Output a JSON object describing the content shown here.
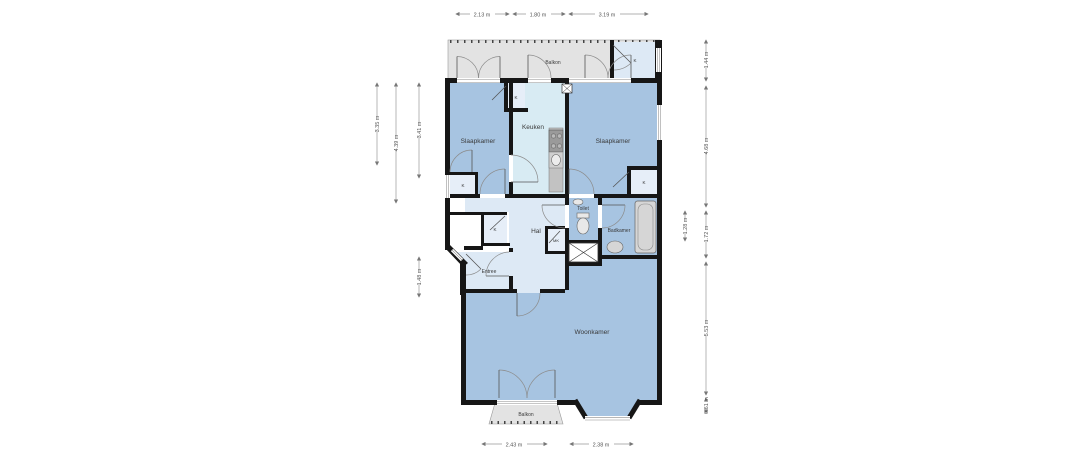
{
  "rooms": {
    "balkon_top": "Balkon",
    "slaapkamer_left": "Slaapkamer",
    "keuken": "Keuken",
    "slaapkamer_right": "Slaapkamer",
    "hal": "Hal",
    "toilet": "Toilet",
    "badkamer": "Badkamer",
    "entree": "Entree",
    "woonkamer": "Woonkamer",
    "balkon_bottom": "Balkon"
  },
  "closets": {
    "k": "K",
    "mk": "MK"
  },
  "dimensions": {
    "top": [
      "2.13 m",
      "1.80 m",
      "3.19 m"
    ],
    "left": [
      "3.35 m",
      "4.39 m",
      "3.41 m",
      "1.48 m"
    ],
    "right": [
      "1.44 m",
      "4.68 m",
      "1.28 m",
      "1.72 m",
      "5.53 m",
      "0.61 m"
    ],
    "bottom": [
      "2.43 m",
      "2.38 m"
    ]
  },
  "colors": {
    "wall": "#161616",
    "room_blue": "#a7c4e1",
    "room_light_blue": "#dde9f5",
    "kitchen_blue": "#d8ebf3",
    "closet_blue": "#e6eef8",
    "balcony_gray": "#e3e3e3",
    "counter_gray": "#c2c2c2",
    "dimension_text": "#555555"
  }
}
